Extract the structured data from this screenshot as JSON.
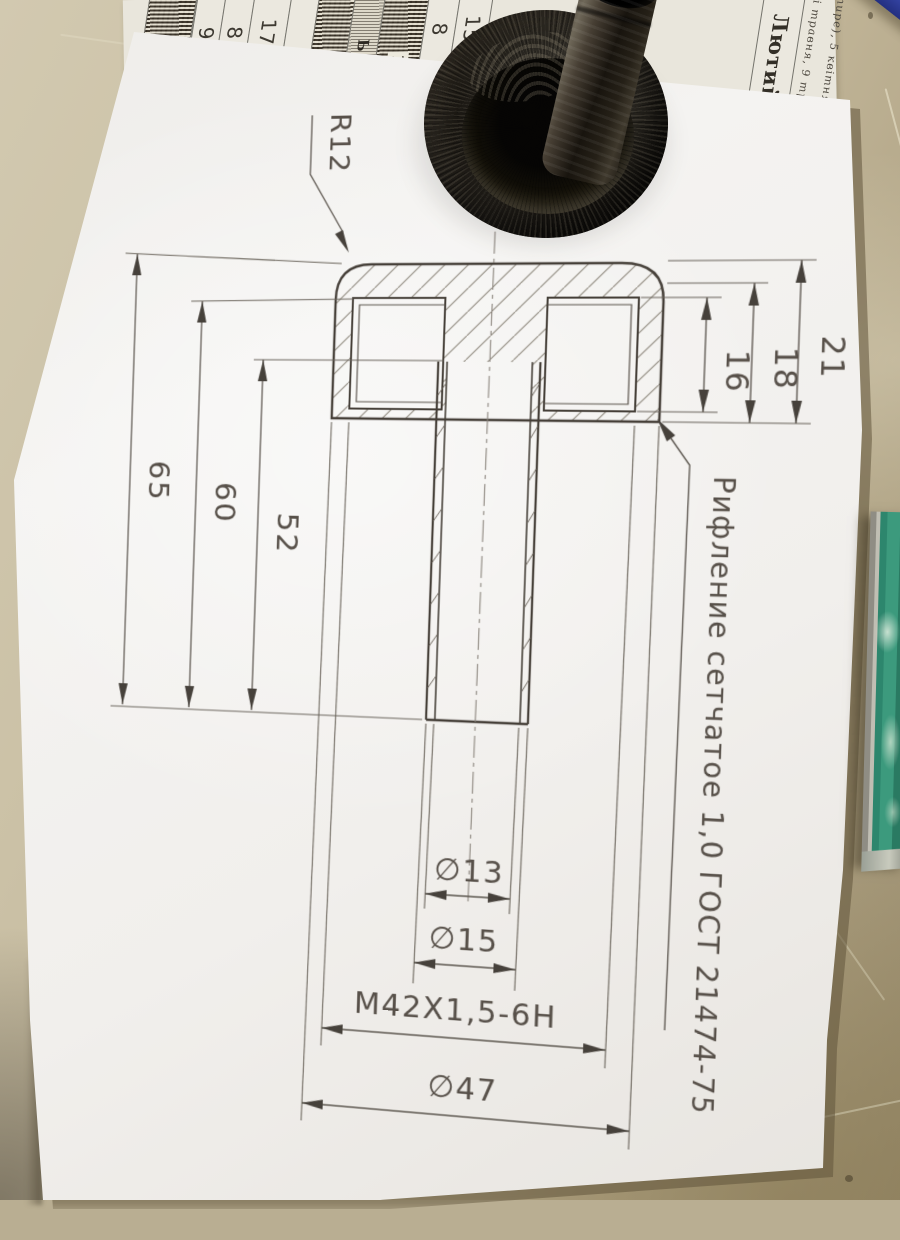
{
  "drawing": {
    "radius_label": "R12",
    "note_label": "Рифление сетчатое 1,0 ГОСТ 21474-75",
    "dim_65": "65",
    "dim_60": "60",
    "dim_52": "52",
    "dim_21": "21",
    "dim_18": "18",
    "dim_16": "16",
    "dia_13": "∅13",
    "dia_15": "∅15",
    "thread": "M42X1,5-6H",
    "dia_47": "∅47"
  },
  "calendar": {
    "month_label": "Лютий",
    "strips": [
      {
        "type": "ornate",
        "cells": []
      },
      {
        "type": "cells",
        "cells": [
          "9",
          "2"
        ]
      },
      {
        "type": "cells",
        "cells": [
          "8",
          "2"
        ]
      },
      {
        "type": "cells",
        "cells": [
          "17",
          "9"
        ]
      },
      {
        "type": "cells",
        "cells": [
          "16"
        ]
      },
      {
        "type": "ornate",
        "cells": [
          "15"
        ]
      },
      {
        "type": "header",
        "cells": [
          "Ь 22д"
        ]
      },
      {
        "type": "ornate",
        "cells": [
          "17"
        ]
      },
      {
        "type": "cells",
        "cells": [
          "8",
          "7"
        ]
      },
      {
        "type": "cells",
        "cells": [
          "15",
          "14"
        ]
      },
      {
        "type": "cells",
        "cells": [
          "9",
          "7",
          "6",
          "5"
        ]
      },
      {
        "type": "cells",
        "cells": [
          "2",
          "1",
          "8",
          "9"
        ]
      },
      {
        "type": "month",
        "cells": [
          "Лютий"
        ]
      },
      {
        "type": "note",
        "cells": [
          "і травня, 9 трав"
        ]
      },
      {
        "type": "note",
        "cells": [
          "тире), 5 квітня (п"
        ]
      }
    ]
  },
  "colors": {
    "paper": "#f2f0ed",
    "desk": "#c2b699",
    "line": "#4b463f",
    "knob": "#1b1813",
    "green_tool": "#3c9a7d",
    "blue_tool": "#3d4eb5"
  }
}
